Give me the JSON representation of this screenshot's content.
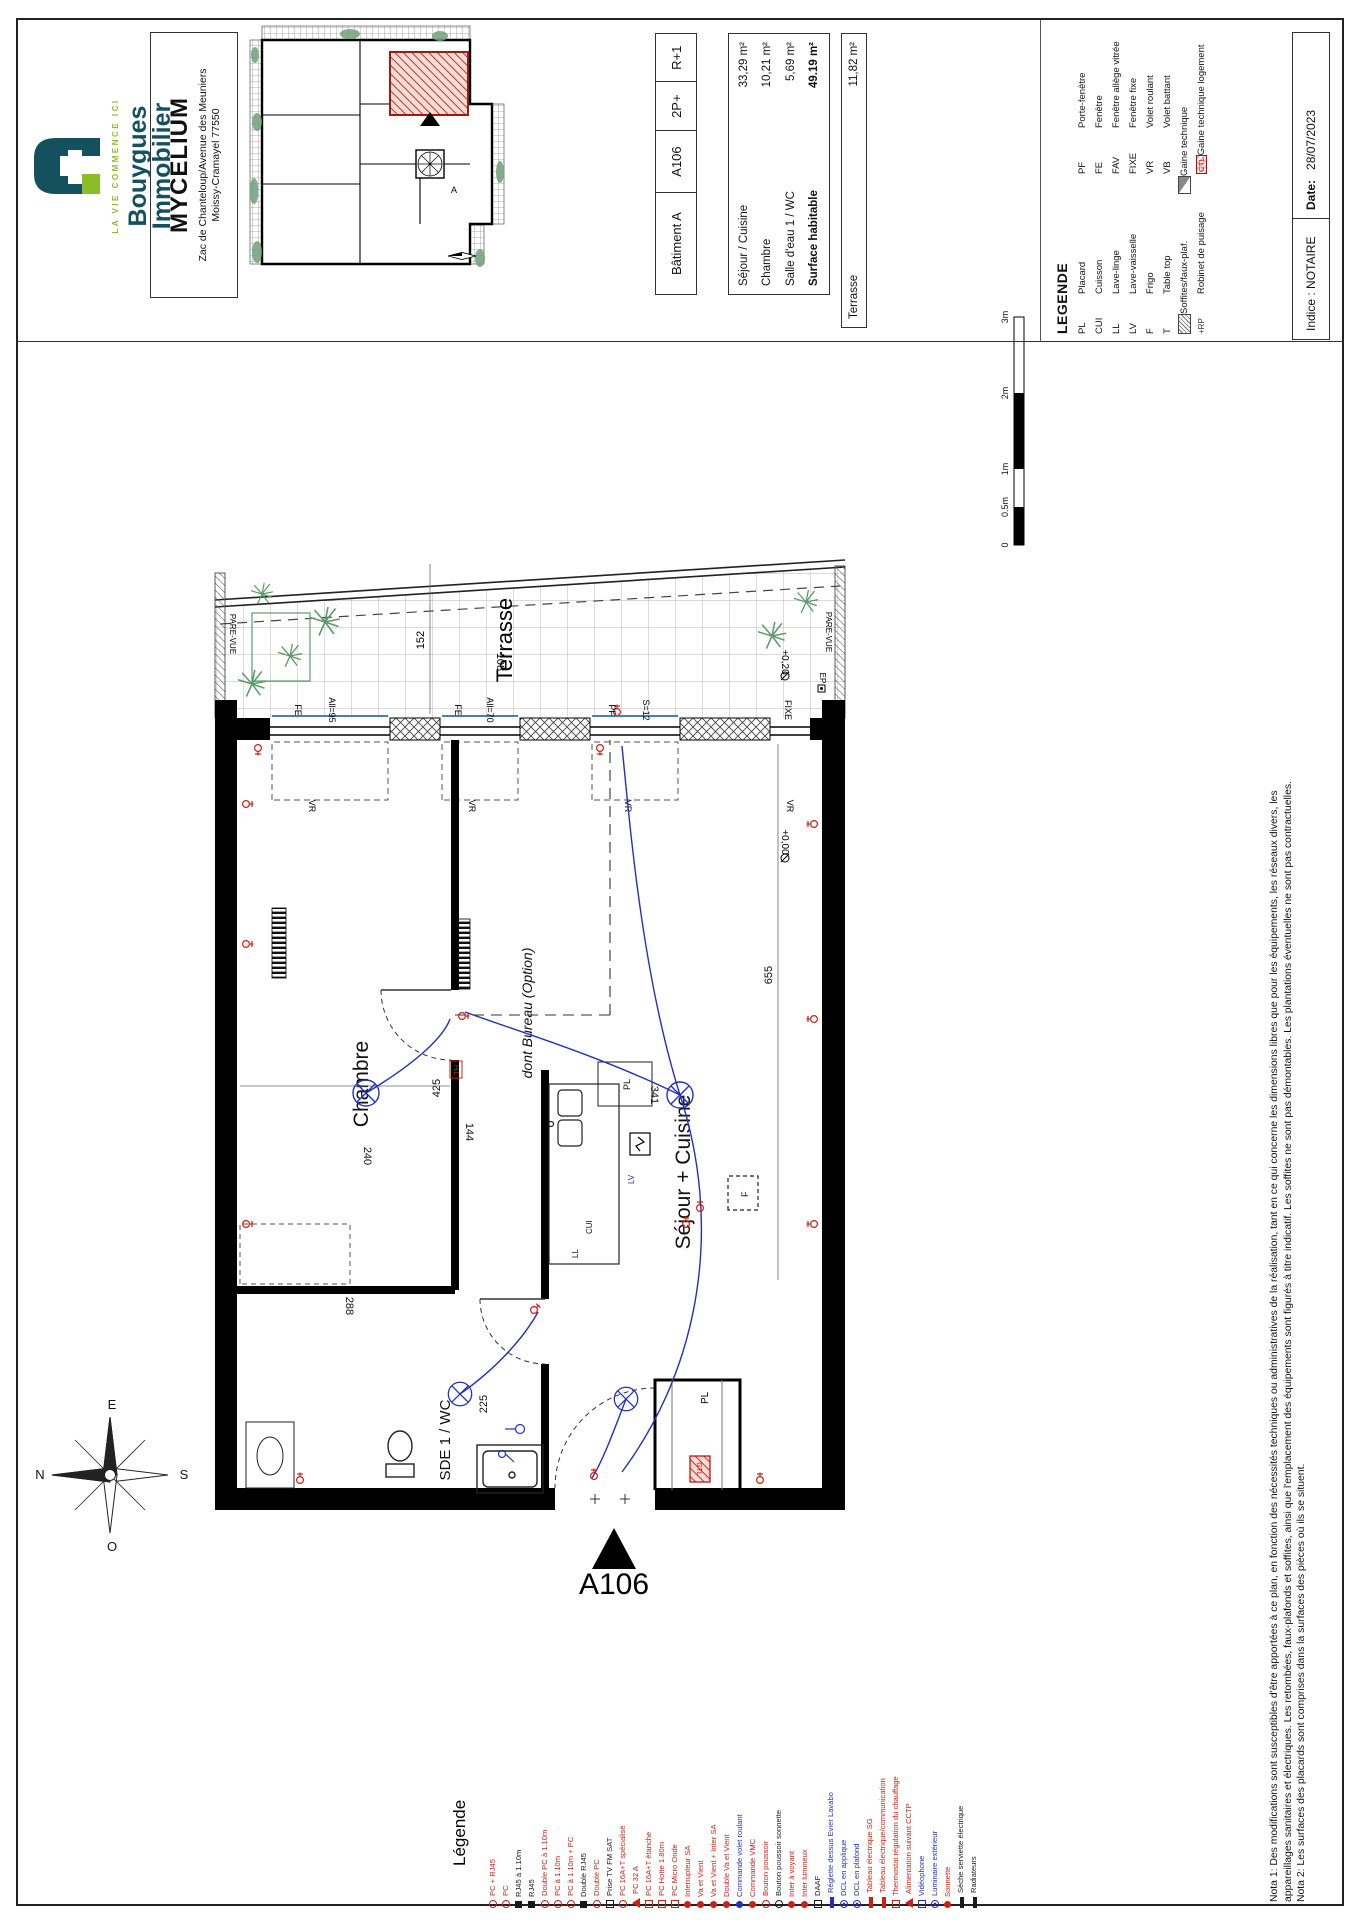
{
  "branding": {
    "name_line1": "Bouygues",
    "name_line2": "Immobilier",
    "tagline": "LA VIE COMMENCE ICI",
    "colors": {
      "teal": "#15505f",
      "green": "#8bbd27"
    }
  },
  "project": {
    "name": "MYCELIUM",
    "address_line1": "Zac de Chanteloup/Avenue des Meuniers",
    "address_line2": "Moissy-Cramayel 77550"
  },
  "unit": {
    "building": "Bâtiment A",
    "number": "A106",
    "type": "2P+",
    "floor": "R+1"
  },
  "areas": {
    "rows": [
      {
        "label": "Séjour / Cuisine",
        "value": "33,29  m²",
        "bold": ""
      },
      {
        "label": "Chambre",
        "value": "10,21  m²",
        "bold": ""
      },
      {
        "label": "Salle d'eau 1 / WC",
        "value": "5,69  m²",
        "bold": ""
      },
      {
        "label": "Surface habitable",
        "value": "49.19  m²",
        "bold": "bold"
      }
    ],
    "terrace_label": "Terrasse",
    "terrace_value": "11,82  m²"
  },
  "legend": {
    "title": "LEGENDE",
    "rows": [
      {
        "a1": "PL",
        "l1": "Placard",
        "a2": "PF",
        "l2": "Porte-fenêtre"
      },
      {
        "a1": "CUI",
        "l1": "Cuisson",
        "a2": "FE",
        "l2": "Fenêtre"
      },
      {
        "a1": "LL",
        "l1": "Lave-linge",
        "a2": "FAV",
        "l2": "Fenêtre allège vitrée"
      },
      {
        "a1": "LV",
        "l1": "Lave-vaisselle",
        "a2": "FIXE",
        "l2": "Fenêtre fixe"
      },
      {
        "a1": "F",
        "l1": "Frigo",
        "a2": "VR",
        "l2": "Volet roulant"
      },
      {
        "a1": "T",
        "l1": "Table top",
        "a2": "VB",
        "l2": "Volet battant"
      },
      {
        "a1": "",
        "c1": "sym-hatch",
        "l1": "Soffites/faux-plaf.",
        "a2": "",
        "c2": "sym-tri",
        "l2": "Gaine technique"
      },
      {
        "a1": "+RP",
        "c1": "sym-rp",
        "l1": "Robinet de puisage",
        "a2": "GTL",
        "c2": "sym-gtl",
        "l2": "Gaine technique logement"
      }
    ]
  },
  "revision": {
    "indice": "Indice : NOTAIRE",
    "date_label": "Date:",
    "date_value": "28/07/2023"
  },
  "scale_bar": {
    "labels": [
      "0",
      "0.5m",
      "1m",
      "2m",
      "3m"
    ]
  },
  "notes": {
    "line1": "Nota 1: Des modifications sont susceptibles d'être apportées à ce plan, en fonction des nécessités techniques ou administratives de la réalisation, tant en ce qui concerne les dimensions libres que pour les équipements, les réseaux divers, les",
    "line2": "appareillages sanitaires et électriques. Les retombées, faux-plafonds et soffites, ainsi que l'emplacement des équipements sont figurés à titre indicatif. Les soffites ne sont pas démontables. Les plantations éventuelles ne sont pas contractuelles.",
    "line3": "Nota 2: Les surfaces des placards sont comprises dans la surfaces des pièces où ils se situent."
  },
  "plan": {
    "labels": {
      "chambre": "Chambre",
      "sejour": "Séjour + Cuisine",
      "sde": "SDE 1 / WC",
      "bureau": "dont Bureau (Option)",
      "terrasse": "Terrasse",
      "pare_vue": "PARE-VUE",
      "pl": "PL",
      "ll": "LL",
      "lv": "LV",
      "cui": "CUI",
      "f": "F",
      "gtl": "GTL",
      "th": "TH",
      "ep": "EP"
    },
    "dims": {
      "d152": "152",
      "d108": "108",
      "d425": "425",
      "d240": "240",
      "d288": "288",
      "d225": "225",
      "d144": "144",
      "d341": "341",
      "d655": "655"
    },
    "windows": {
      "w1_type": "FE",
      "w1_allege": "All=95",
      "w2_type": "FE",
      "w2_allege": "All=70",
      "w3_type": "PF",
      "w3_s": "S=12",
      "w4_type": "FIXE",
      "shutter": "VR"
    },
    "levels": {
      "terrace": "+0,20",
      "main": "+0,00"
    },
    "a106": "A106"
  },
  "compass": {
    "n": "N",
    "e": "E",
    "s": "S",
    "o": "O"
  },
  "site_map": {
    "unit_marker": "A"
  },
  "electrical_legend": {
    "title": "Légende",
    "items": [
      {
        "t": "PC + RJ45",
        "c": "c-red",
        "s": "ring"
      },
      {
        "t": "PC",
        "c": "c-red",
        "s": "ring"
      },
      {
        "t": "RJ45 à 1.10m",
        "c": "c-black",
        "s": "sq"
      },
      {
        "t": "RJ45",
        "c": "c-black",
        "s": "sq"
      },
      {
        "t": "Double PC à 1.10m",
        "c": "c-red",
        "s": "ring"
      },
      {
        "t": "PC à 1.10m",
        "c": "c-red",
        "s": "ring"
      },
      {
        "t": "PC à 1.10m + PC",
        "c": "c-red",
        "s": "ring"
      },
      {
        "t": "Double RJ45",
        "c": "c-black",
        "s": "sq"
      },
      {
        "t": "Double PC",
        "c": "c-red",
        "s": "ring"
      },
      {
        "t": "Prise TV FM SAT",
        "c": "c-black",
        "s": "sqo"
      },
      {
        "t": "PC 16A+T spécialisé",
        "c": "c-red",
        "s": "ring"
      },
      {
        "t": "PC 32 A",
        "c": "c-red",
        "s": "tri"
      },
      {
        "t": "PC 16A+T étanche",
        "c": "c-red",
        "s": "sqo"
      },
      {
        "t": "PC Hotte 1.80m",
        "c": "c-red",
        "s": "sqo"
      },
      {
        "t": "PC Micro Onde",
        "c": "c-red",
        "s": "sqo"
      },
      {
        "t": "Interrupteur SA",
        "c": "c-red",
        "s": "dot"
      },
      {
        "t": "Va et Vient",
        "c": "c-red",
        "s": "dot"
      },
      {
        "t": "Va et Vient + Inter SA",
        "c": "c-red",
        "s": "dot"
      },
      {
        "t": "Double Va et Vient",
        "c": "c-red",
        "s": "dot"
      },
      {
        "t": "Commande volet roulant",
        "c": "c-blue",
        "s": "dot"
      },
      {
        "t": "Commande VMC",
        "c": "c-red",
        "s": "dot"
      },
      {
        "t": "Bouton poussoir",
        "c": "c-red",
        "s": "ring"
      },
      {
        "t": "Bouton poussoir sonnette",
        "c": "c-black",
        "s": "ring"
      },
      {
        "t": "Inter à voyant",
        "c": "c-red",
        "s": "dot"
      },
      {
        "t": "Inter lumineux",
        "c": "c-red",
        "s": "dot"
      },
      {
        "t": "DAAF",
        "c": "c-black",
        "s": "sqo"
      },
      {
        "t": "Réglette dessus Evier Lavabo",
        "c": "c-blue",
        "s": "bar"
      },
      {
        "t": "DCL en applique",
        "c": "c-blue",
        "s": "circx"
      },
      {
        "t": "DCL en plafond",
        "c": "c-blue",
        "s": "circx"
      },
      {
        "t": "Tableau électrique SG",
        "c": "c-red",
        "s": "bar"
      },
      {
        "t": "Tableau électrique/communication",
        "c": "c-red",
        "s": "bar"
      },
      {
        "t": "Thermostat régulation du chauffage",
        "c": "c-red",
        "s": "sqo"
      },
      {
        "t": "Alimentation suivant CCTP",
        "c": "c-red",
        "s": "tri"
      },
      {
        "t": "Vidéophone",
        "c": "c-blue",
        "s": "sqo"
      },
      {
        "t": "Luminaire extérieur",
        "c": "c-blue",
        "s": "circx"
      },
      {
        "t": "Sonnette",
        "c": "c-red",
        "s": "dot"
      },
      {
        "t": "Sèche serviette électrique",
        "c": "c-black",
        "s": "bar"
      },
      {
        "t": "Radiateurs",
        "c": "c-black",
        "s": "bar"
      }
    ]
  }
}
